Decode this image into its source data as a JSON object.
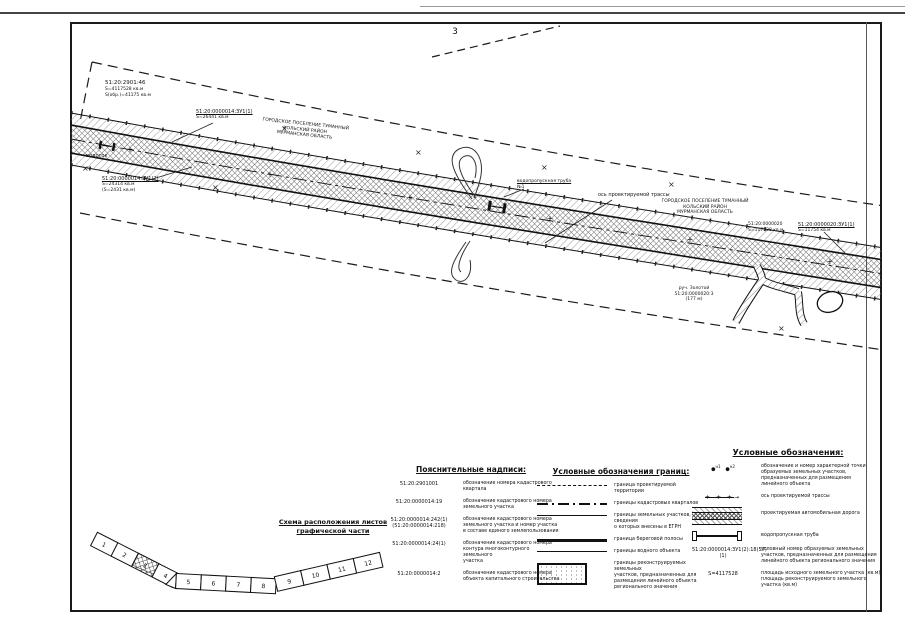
{
  "page": {
    "number": "3"
  },
  "map": {
    "axis_mark": "+",
    "grid_cross": "×",
    "labels": {
      "kv_topleft": {
        "l1": "51:20:2901:46",
        "l2": "S=4117528 кв.м",
        "l3": "S(обр.)=41175 кв.м"
      },
      "settlement_top": {
        "l1": "ГОРОДСКОЕ ПОСЕЛЕНИЕ ТУМАННЫЙ",
        "l2": "КОЛЬСКИЙ РАЙОН",
        "l3": "МУРМАНСКАЯ ОБЛАСТЬ"
      },
      "settlement_right": {
        "l1": "ГОРОДСКОЕ ПОСЕЛЕНИЕ ТУМАННЫЙ",
        "l2": "КОЛЬСКИЙ РАЙОН",
        "l3": "МУРМАНСКАЯ ОБЛАСТЬ"
      },
      "callout_zu1": {
        "l1": "51:20:0000014:ЗУ1(1)",
        "l2": "S=26441 кв.м"
      },
      "callout_zu2": {
        "l1": "51:20:0000014:ЗУ1(2)",
        "l2": "S=24314 кв.м",
        "l3": "(S=2431 кв.м)"
      },
      "callout_zu3": {
        "l1": "51:20:0000020:ЗУ1(1)",
        "l2": "S=11754 кв.м"
      },
      "kv_right": {
        "l1": "51:20:0000020",
        "l2": "S=117528 кв.м"
      },
      "axis_callout": "ось проектируемой трассы",
      "culvert_callout": {
        "l1": "водопропускная труба",
        "l2": "№1"
      },
      "waterflow": "водоток",
      "river": {
        "l1": "руч. Золотой",
        "l2": "51:20:0000020:3",
        "l3": "(177 м)"
      }
    }
  },
  "legend_notes": {
    "title": "Пояснительные надписи:",
    "rows": [
      {
        "num": "51:20:2901001",
        "desc": "обозначение номера кадастрового\nквартала"
      },
      {
        "num": "51:20:0000014:19",
        "desc": "обозначение кадастрового номера\nземельного участка"
      },
      {
        "num": "51:20:0000014:242(1)\n(51:20:0000014:218)",
        "desc": "обозначение кадастрового номера\nземельного участка и номер участка\nв составе единого землепользования"
      },
      {
        "num": "51:20:0000014:24(1)",
        "desc": "обозначение кадастрового номера\nконтура многоконтурного земельного\nучастка"
      },
      {
        "num": "51:20:0000014:2",
        "desc": "обозначение кадастрового номера\nобъекта капитального строительства"
      }
    ]
  },
  "legend_borders": {
    "title": "Условные обозначения границ:",
    "rows": [
      {
        "desc": "граница проектируемой территории"
      },
      {
        "desc": "границы кадастровых кварталов"
      },
      {
        "desc": "границы земельных участков, сведения\nо которых внесены в ЕГРН"
      },
      {
        "desc": "граница береговой полосы"
      },
      {
        "desc": "границы водного объекта"
      },
      {
        "desc": "границы реконструируемых земельных\nучастков, предназначенных для\nразмещения линейного объекта\nрегионального значения"
      }
    ]
  },
  "legend_symbols": {
    "title": "Условные обозначения:",
    "points": {
      "p1": "н1",
      "p2": "н2",
      "dot": "●",
      "desc": "обозначение и номер характерной точки\nобразуемых земельных участков,\nпредназначенных для размещения\nлинейного объекта"
    },
    "axis": {
      "sample": "+   +   +",
      "arrow": "→",
      "desc": "ось проектируемой трассы"
    },
    "road": {
      "desc": "проектируемая автомобильная дорога"
    },
    "culvert": {
      "desc": "водопропускная труба"
    },
    "cadnum": {
      "sample": "51:20:0000014:ЗУ1(2):18(57)(1)",
      "desc": "условный номер образуемых земельных\nучастков, предназначенных для размещения\nлинейного объекта регионального значения"
    },
    "area": {
      "sample": "S=4117528",
      "desc": "площадь исходного земельного участка (кв.м)/\nплощадь реконструируемого земельного участка (кв.м)"
    }
  },
  "scheme": {
    "title_line1": "Схема расположения листов",
    "title_line2": "графической части",
    "sheets": [
      "1",
      "2",
      "3",
      "4",
      "5",
      "6",
      "7",
      "8",
      "9",
      "10",
      "11",
      "12"
    ],
    "current_sheet": "3"
  }
}
